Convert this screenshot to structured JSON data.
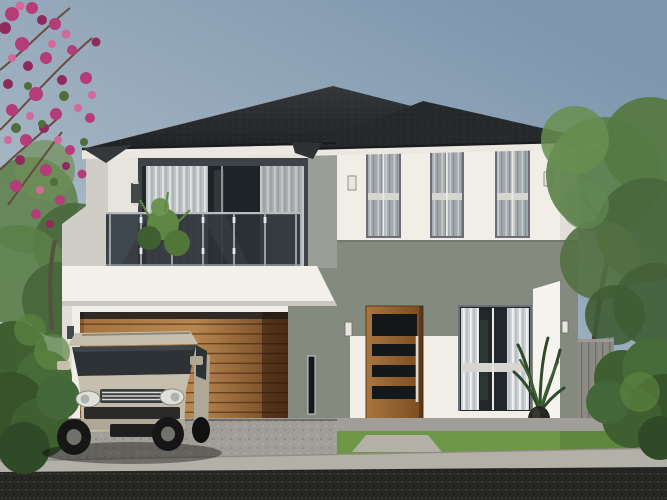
{
  "meta": {
    "description": "Architectural exterior rendering of a modern two-storey house with dark hip roof, glass balcony, timber garage door, timber entry door, and a champagne-coloured SUV parked on the driveway",
    "time_of_day": "daytime",
    "style": "contemporary render"
  },
  "scene": {
    "objects": [
      "sky",
      "pink-bougainvillea",
      "left-garden-trees",
      "right-tree",
      "right-hedge",
      "boundary-fence",
      "hip-roof-main",
      "hip-roof-secondary",
      "balcony-glass-railing",
      "balcony-plant",
      "upstairs-sliding-door",
      "upstairs-window-1",
      "upstairs-window-2",
      "upstairs-window-3",
      "wall-sconces",
      "garage-door-timber",
      "front-door-timber",
      "entry-window",
      "potted-plant",
      "porch-step",
      "lawn",
      "walkway",
      "driveway",
      "sidewalk",
      "asphalt-road",
      "suv-car",
      "left-hedge"
    ]
  },
  "colors": {
    "sky_top": "#7e97ae",
    "sky_mid": "#a3b4c2",
    "sky_horizon": "#c9d1d5",
    "roof_main": "#2b2e30",
    "roof_secondary": "#26292b",
    "roof_gutter": "#1a1c1e",
    "eave_dark": "#35383a",
    "fascia": "#eae8e1",
    "wall_white": "#f0eee7",
    "wall_bright": "#f6f4ee",
    "wall_shadow": "#d7d5ce",
    "wall_gray": "#9b9d97",
    "west_wall": "#cfcdc6",
    "slab_white": "#f2f0e9",
    "sage_wall": "#848a7d",
    "sage_dark": "#6e746b",
    "glass_dark": "#22272c",
    "window_frame": "#6a7076",
    "slider_frame": "#3f4347",
    "curtain_base": "#b9c0c6",
    "curtain_light": "#e6e8e8",
    "curtain_dim": "#98a1a9",
    "curtain_white_base": "#cdd2d5",
    "sill_bar": "#d6d5d0",
    "mullion": "#eceae4",
    "balcony_glass": "#2c3237",
    "stainless": "#b9bdc0",
    "garage_wood_light": "#b8874f",
    "garage_wood_mid": "#a5713c",
    "garage_wood_dark": "#6b4120",
    "garage_reveal": "#2f2a24",
    "door_wood_light": "#a8763f",
    "door_wood_dark": "#7a4a21",
    "door_glass": "#15181b",
    "handle_metal": "#d8d8d6",
    "porch_terracotta": "#8a5731",
    "grass": "#6d9747",
    "grass_dark": "#577d38",
    "hedge": "#3f5f31",
    "hedge_light": "#5f8743",
    "tree_green": "#5b7f48",
    "tree_dark": "#49683c",
    "trunk": "#4a4136",
    "driveway": "#a09e96",
    "sidewalk": "#b2b0a7",
    "road": "#262625",
    "fence": "#8b8b84",
    "fence_slat": "#6e6e68",
    "car_body": "#c6bfae",
    "car_body_dark": "#b0a897",
    "car_glass": "#2d3236",
    "car_trim": "#2a2a28",
    "headlight": "#dfe0da",
    "tire": "#161616",
    "rim": "#71716c",
    "flower": "#b43c77",
    "flower_dark": "#8f2a5c",
    "flower_light": "#d16a9b",
    "pot": "#24261f",
    "sconce": "#e8e6e0",
    "sconce_dark": "#45484b"
  }
}
